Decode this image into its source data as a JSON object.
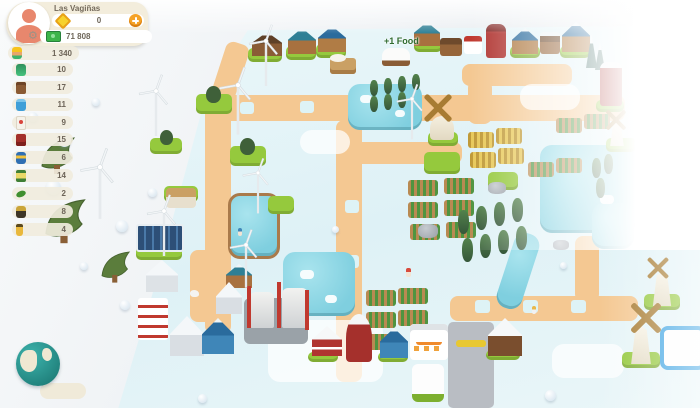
{
  "hud": {
    "player": {
      "name": "Las Vagiñas",
      "gem_count": "0",
      "money": "71 808",
      "workers": "1 340"
    },
    "resources": [
      {
        "icon": "pickle-jar",
        "value": "10"
      },
      {
        "icon": "wooden-crate",
        "value": "17"
      },
      {
        "icon": "water-barrel",
        "value": "11"
      },
      {
        "icon": "milk-box",
        "value": "9"
      },
      {
        "icon": "red-crate",
        "value": "15"
      },
      {
        "icon": "fuel-barrel",
        "value": "6"
      },
      {
        "icon": "canned-food",
        "value": "14"
      },
      {
        "icon": "cucumber",
        "value": "2"
      },
      {
        "icon": "honey-jar",
        "value": "8"
      },
      {
        "icon": "oil-bottle",
        "value": "4"
      }
    ]
  },
  "scene": {
    "floating_label": "+1 Food"
  },
  "colors": {
    "accent_orange": "#f5a226",
    "money_green": "#3cb44a",
    "card_cream": "#f3eddc",
    "grass": "#95c93d",
    "road": "#f4c892",
    "pond": "#85d2e2",
    "map_ice": "#e3f4f7",
    "silo_red": "#a5302c",
    "selection_blue": "#3ba3e3"
  }
}
